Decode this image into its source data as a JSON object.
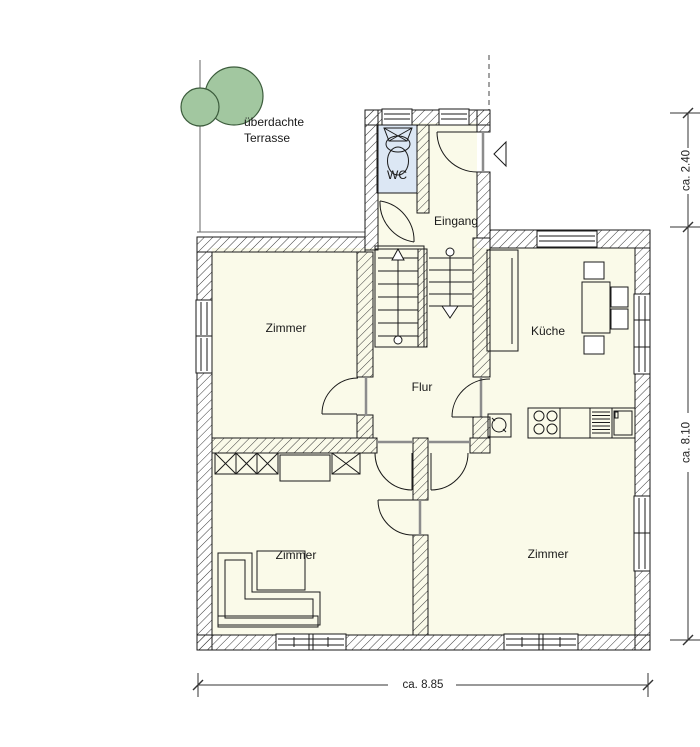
{
  "drawing": {
    "type": "floor-plan",
    "labels": {
      "terrace": "überdachte Terrasse",
      "wc": "WC",
      "entrance": "Eingang",
      "room_top_left": "Zimmer",
      "kitchen": "Küche",
      "hall": "Flur",
      "room_bottom_left": "Zimmer",
      "room_bottom_right": "Zimmer"
    },
    "dimensions": {
      "vestibule_depth": "ca. 2.40",
      "house_depth": "ca. 8.10",
      "house_width": "ca. 8.85"
    },
    "colors": {
      "room_fill": "#FAFAE9",
      "wc_fill": "#DCE7F4",
      "tree_fill": "#A2C7A0",
      "tree_stroke": "#3C5C3C",
      "wall_line": "#1A1A1A",
      "frame_gray": "#8C8C8C"
    }
  }
}
